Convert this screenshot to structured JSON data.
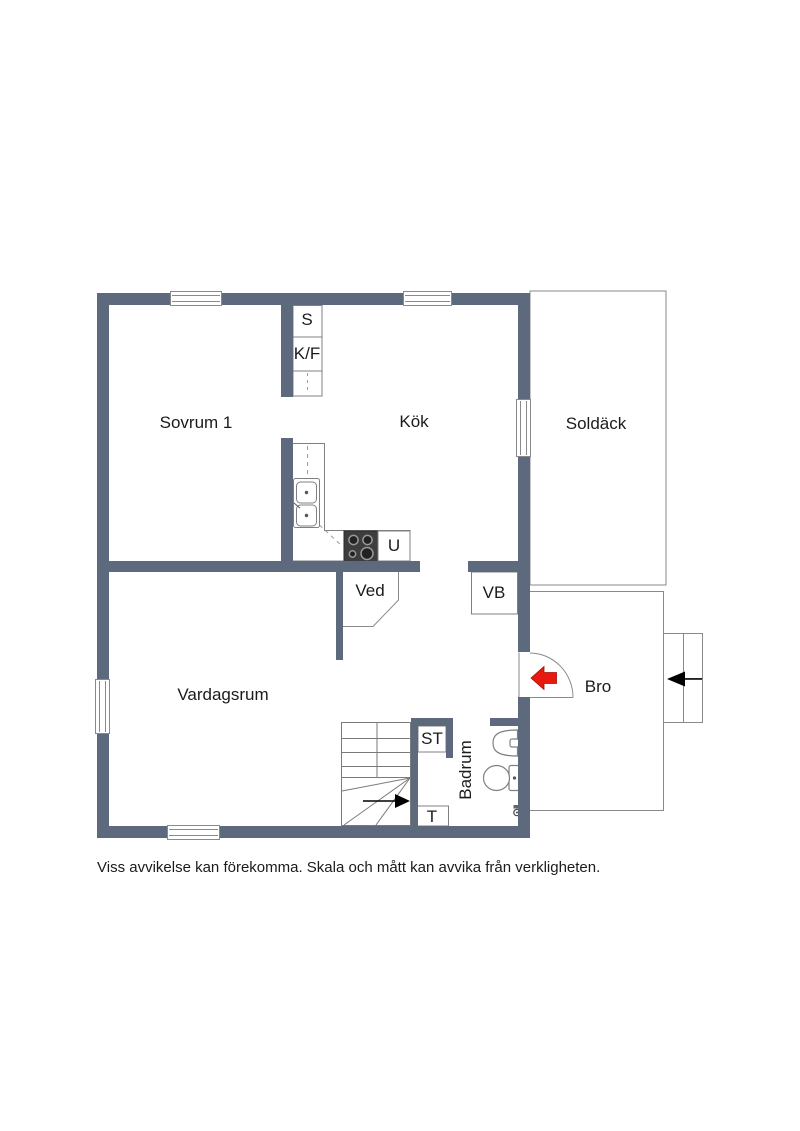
{
  "plan": {
    "rooms": {
      "sovrum": "Sovrum 1",
      "kok": "Kök",
      "soldack": "Soldäck",
      "vardagsrum": "Vardagsrum",
      "bro": "Bro",
      "badrum": "Badrum",
      "ved": "Ved"
    },
    "labels": {
      "closet": "S",
      "fridge_freezer": "K/F",
      "oven": "U",
      "water_heater": "VB",
      "cleaning_closet": "ST",
      "laundry": "T"
    },
    "colors": {
      "wall": "#5d6a7d",
      "entrance_arrow": "#e8190f",
      "thin_line": "#8a8a8a",
      "stove": "#3d3d3d"
    }
  },
  "footer": {
    "disclaimer": "Viss avvikelse kan förekomma. Skala och mått kan avvika från verkligheten."
  }
}
